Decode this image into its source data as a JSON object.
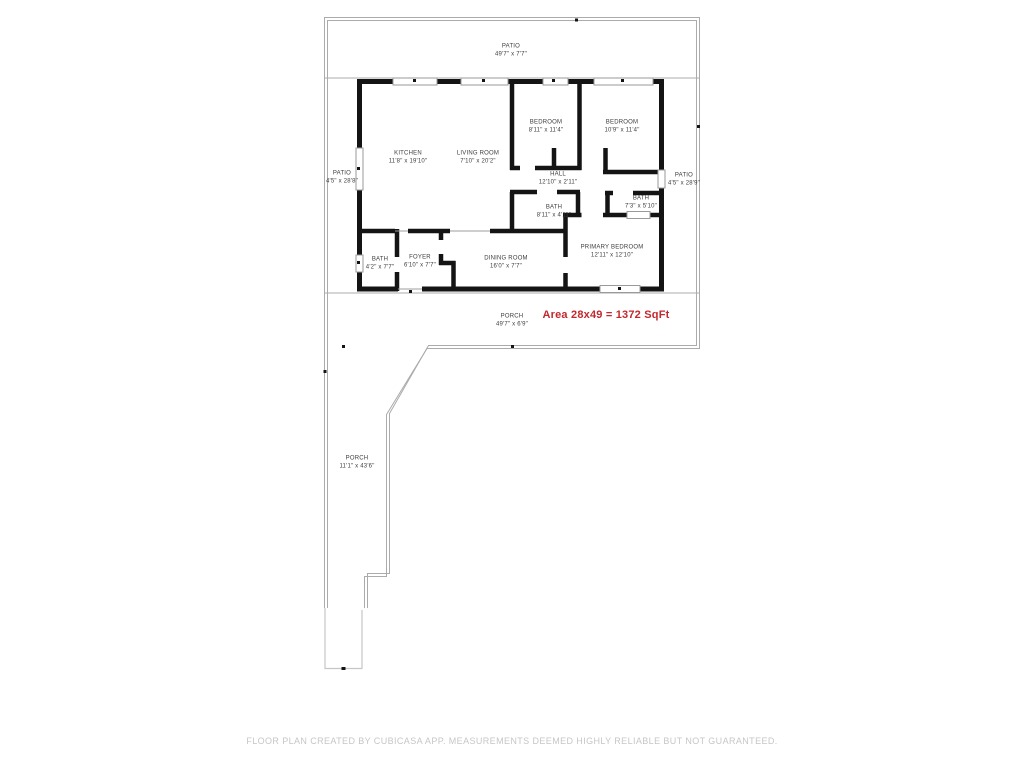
{
  "rooms": [
    {
      "name": "PATIO",
      "dims": "49'7\" x 7'7\""
    },
    {
      "name": "KITCHEN",
      "dims": "11'8\" x 19'10\""
    },
    {
      "name": "LIVING ROOM",
      "dims": "7'10\" x 20'2\""
    },
    {
      "name": "BEDROOM",
      "dims": "8'11\" x 11'4\""
    },
    {
      "name": "BEDROOM",
      "dims": "10'9\" x 11'4\""
    },
    {
      "name": "HALL",
      "dims": "12'10\" x 2'11\""
    },
    {
      "name": "BATH",
      "dims": "8'11\" x 4'11\""
    },
    {
      "name": "BATH",
      "dims": "7'3\" x 5'10\""
    },
    {
      "name": "PRIMARY BEDROOM",
      "dims": "12'11\" x 12'10\""
    },
    {
      "name": "DINING ROOM",
      "dims": "16'0\" x 7'7\""
    },
    {
      "name": "FOYER",
      "dims": "6'10\" x 7'7\""
    },
    {
      "name": "BATH",
      "dims": "4'2\" x 7'7\""
    },
    {
      "name": "PATIO",
      "dims": "4'5\" x 28'8\""
    },
    {
      "name": "PATIO",
      "dims": "4'5\" x 28'9\""
    },
    {
      "name": "PORCH",
      "dims": "49'7\" x 6'9\""
    },
    {
      "name": "PORCH",
      "dims": "11'1\" x 43'6\""
    }
  ],
  "area_note": "Area 28x49 = 1372 SqFt",
  "footer": "FLOOR PLAN CREATED BY CUBICASA APP. MEASUREMENTS DEEMED HIGHLY RELIABLE BUT NOT GUARANTEED.",
  "colors": {
    "wall": "#141414",
    "boundary": "#ababab",
    "steps": "#c6c6c6",
    "window_frame": "#9a9a9a",
    "label_text": "#3e3e3e",
    "area_text": "#c2282d",
    "footer_text": "#c6c6c6"
  }
}
